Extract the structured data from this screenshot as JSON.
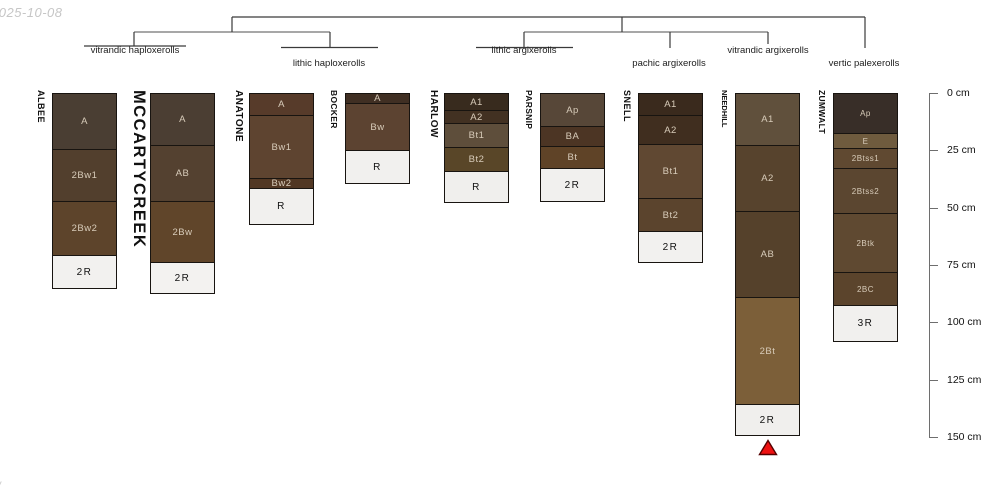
{
  "meta": {
    "date_label": "2025-10-08",
    "corner_mark": "/"
  },
  "tree": {
    "groups": [
      {
        "label": "vitrandic haploxerolls",
        "members": [
          "ALBEE",
          "MCCARTYCREEK"
        ]
      },
      {
        "label": "lithic haploxerolls",
        "members": [
          "ANATONE",
          "BOCKER"
        ]
      },
      {
        "label": "lithic argixerolls",
        "members": [
          "HARLOW",
          "PARSNIP"
        ]
      },
      {
        "label": "pachic argixerolls",
        "members": [
          "SNELL"
        ]
      },
      {
        "label": "vitrandic argixerolls",
        "members": [
          "NEEDHILL"
        ]
      },
      {
        "label": "vertic palexerolls",
        "members": [
          "ZUMWALT"
        ]
      }
    ]
  },
  "chart_data": {
    "type": "soil-profile-columns",
    "ylabel": "depth",
    "unit": "cm",
    "ylim": [
      0,
      150
    ],
    "depth_ticks": [
      {
        "cm": 0,
        "label": "0 cm"
      },
      {
        "cm": 25,
        "label": "25 cm"
      },
      {
        "cm": 50,
        "label": "50 cm"
      },
      {
        "cm": 75,
        "label": "75 cm"
      },
      {
        "cm": 100,
        "label": "100 cm"
      },
      {
        "cm": 125,
        "label": "125 cm"
      },
      {
        "cm": 150,
        "label": "150 cm"
      }
    ],
    "categories": [
      "ALBEE",
      "MCCARTYCREEK",
      "ANATONE",
      "BOCKER",
      "HARLOW",
      "PARSNIP",
      "SNELL",
      "NEEDHILL",
      "ZUMWALT"
    ],
    "soils": [
      {
        "name": "ALBEE",
        "x": 52,
        "horizons": [
          {
            "label": "A",
            "top": 0,
            "bottom": 25,
            "color": "#4a3e33"
          },
          {
            "label": "2Bw1",
            "top": 25,
            "bottom": 48,
            "color": "#523f2d"
          },
          {
            "label": "2Bw2",
            "top": 48,
            "bottom": 72,
            "color": "#5d442b"
          },
          {
            "label": "2R",
            "top": 72,
            "bottom": 87,
            "color": "#f2f1ef"
          }
        ]
      },
      {
        "name": "MCCARTYCREEK",
        "x": 150,
        "horizons": [
          {
            "label": "A",
            "top": 0,
            "bottom": 23,
            "color": "#4b3e33"
          },
          {
            "label": "AB",
            "top": 23,
            "bottom": 48,
            "color": "#544130"
          },
          {
            "label": "2Bw",
            "top": 48,
            "bottom": 75,
            "color": "#60452a"
          },
          {
            "label": "2R",
            "top": 75,
            "bottom": 89,
            "color": "#f3f2f0"
          }
        ]
      },
      {
        "name": "ANATONE",
        "x": 249,
        "horizons": [
          {
            "label": "A",
            "top": 0,
            "bottom": 10,
            "color": "#573b2a"
          },
          {
            "label": "Bw1",
            "top": 10,
            "bottom": 38,
            "color": "#5e4430"
          },
          {
            "label": "Bw2",
            "top": 38,
            "bottom": 43,
            "color": "#513723"
          },
          {
            "label": "R",
            "top": 43,
            "bottom": 59,
            "color": "#f1f0ee"
          }
        ]
      },
      {
        "name": "BOCKER",
        "x": 345,
        "horizons": [
          {
            "label": "A",
            "top": 0,
            "bottom": 5,
            "color": "#402f23"
          },
          {
            "label": "Bw",
            "top": 5,
            "bottom": 26,
            "color": "#5c4331"
          },
          {
            "label": "R",
            "top": 26,
            "bottom": 41,
            "color": "#f1f0ee"
          }
        ]
      },
      {
        "name": "HARLOW",
        "x": 444,
        "horizons": [
          {
            "label": "A1",
            "top": 0,
            "bottom": 8,
            "color": "#382b1e"
          },
          {
            "label": "A2",
            "top": 8,
            "bottom": 14,
            "color": "#423122"
          },
          {
            "label": "Bt1",
            "top": 14,
            "bottom": 25,
            "color": "#5e4e3b"
          },
          {
            "label": "Bt2",
            "top": 25,
            "bottom": 36,
            "color": "#594628"
          },
          {
            "label": "R",
            "top": 36,
            "bottom": 50,
            "color": "#f0efed"
          }
        ]
      },
      {
        "name": "PARSNIP",
        "x": 540,
        "horizons": [
          {
            "label": "Ap",
            "top": 0,
            "bottom": 15,
            "color": "#574738"
          },
          {
            "label": "BA",
            "top": 15,
            "bottom": 24,
            "color": "#4c3524"
          },
          {
            "label": "Bt",
            "top": 24,
            "bottom": 34,
            "color": "#5f4327"
          },
          {
            "label": "2R",
            "top": 34,
            "bottom": 49,
            "color": "#f1f0ee"
          }
        ]
      },
      {
        "name": "SNELL",
        "x": 638,
        "horizons": [
          {
            "label": "A1",
            "top": 0,
            "bottom": 10,
            "color": "#3a2a1d"
          },
          {
            "label": "A2",
            "top": 10,
            "bottom": 23,
            "color": "#402e1f"
          },
          {
            "label": "Bt1",
            "top": 23,
            "bottom": 47,
            "color": "#604832"
          },
          {
            "label": "Bt2",
            "top": 47,
            "bottom": 62,
            "color": "#5b442d"
          },
          {
            "label": "2R",
            "top": 62,
            "bottom": 76,
            "color": "#f2f1ef"
          }
        ]
      },
      {
        "name": "NEEDHILL",
        "x": 735,
        "horizons": [
          {
            "label": "A1",
            "top": 0,
            "bottom": 23,
            "color": "#60503c"
          },
          {
            "label": "A2",
            "top": 23,
            "bottom": 52,
            "color": "#57432d"
          },
          {
            "label": "AB",
            "top": 52,
            "bottom": 90,
            "color": "#55412b"
          },
          {
            "label": "2Bt",
            "top": 90,
            "bottom": 137,
            "color": "#7c5f39"
          },
          {
            "label": "2R",
            "top": 137,
            "bottom": 151,
            "color": "#f0efed"
          }
        ]
      },
      {
        "name": "ZUMWALT",
        "x": 833,
        "horizons": [
          {
            "label": "Ap",
            "top": 0,
            "bottom": 18,
            "color": "#382e28"
          },
          {
            "label": "E",
            "top": 18,
            "bottom": 25,
            "color": "#6f5b3e"
          },
          {
            "label": "2Btss1",
            "top": 25,
            "bottom": 34,
            "color": "#604931"
          },
          {
            "label": "2Btss2",
            "top": 34,
            "bottom": 54,
            "color": "#5b4630"
          },
          {
            "label": "2Btk",
            "top": 54,
            "bottom": 80,
            "color": "#5f4931"
          },
          {
            "label": "2BC",
            "top": 80,
            "bottom": 95,
            "color": "#5b442c"
          },
          {
            "label": "3R",
            "top": 95,
            "bottom": 111,
            "color": "#f1f0ee"
          }
        ]
      }
    ],
    "marker": {
      "soil": "NEEDHILL",
      "shape": "triangle-up",
      "fill": "#ee1111",
      "stroke": "#550000"
    }
  }
}
